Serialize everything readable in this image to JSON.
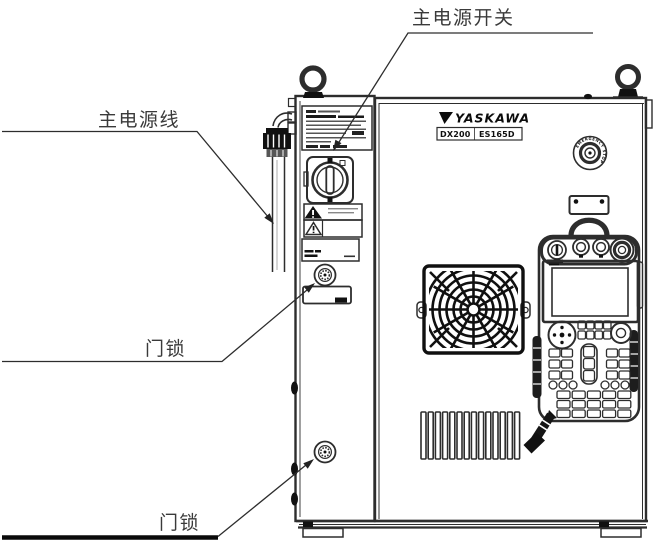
{
  "figure": {
    "type": "technical-illustration",
    "subject": "robot-controller-cabinet-front-view"
  },
  "callouts": {
    "main_power_switch": {
      "label": "主电源开关"
    },
    "main_power_cable": {
      "label": "主电源线"
    },
    "door_lock_upper": {
      "label": "门锁"
    },
    "door_lock_lower": {
      "label": "门锁"
    }
  },
  "cabinet": {
    "brand": "YASKAWA",
    "model_series": "DX200",
    "model_code": "ES165D",
    "estop_text": "EMERGENCY STOP"
  },
  "colors": {
    "line": "#2d2d2d",
    "dark_fill": "#111111",
    "label_text": "#3a3a3a",
    "background": "#ffffff"
  }
}
